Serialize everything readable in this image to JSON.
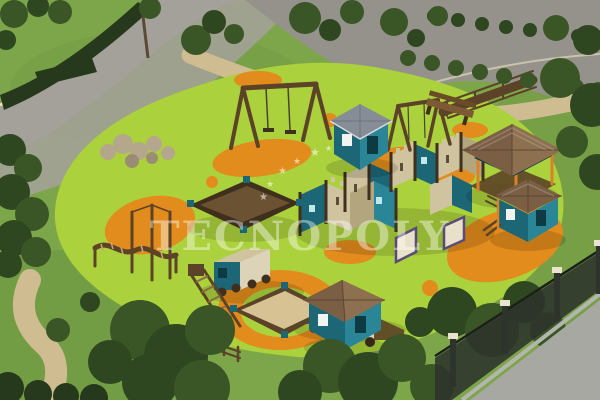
{
  "watermark": {
    "text": "TECNOPOLY",
    "star_count": 6
  },
  "palette": {
    "grass": "#7da64b",
    "grass_dark": "#628c39",
    "surface": "#abd23c",
    "orange": "#e28c1d",
    "road": "#a3a19a",
    "road2": "#94928b",
    "road_light": "#a8a8a3",
    "path": "#cfbc91",
    "curb": "#ece3c2",
    "tree": "#3a5526",
    "tree2": "#2e4720",
    "hedge": "#26391c",
    "wood": "#5c4226",
    "wood_dark": "#3f2f1d",
    "castle_tan": "#cfc3a0",
    "castle_tan_dark": "#b3a67f",
    "roof": "#7b5f45",
    "roof_light": "#8d7050",
    "roof_gray": "#868d96",
    "teal": "#1d6675",
    "teal_light": "#2a8596",
    "teal_dark": "#0e3a44",
    "sand": "#d6c293",
    "cream": "#ddd3b9",
    "orange_post": "#d9822b",
    "fence": "#2e332c",
    "fence_cap": "#e9e4cf",
    "rock": "#b5a78c",
    "watermark_color": "rgba(255,255,255,0.42)",
    "watermark_star_color": "rgba(255,255,255,0.55)"
  }
}
